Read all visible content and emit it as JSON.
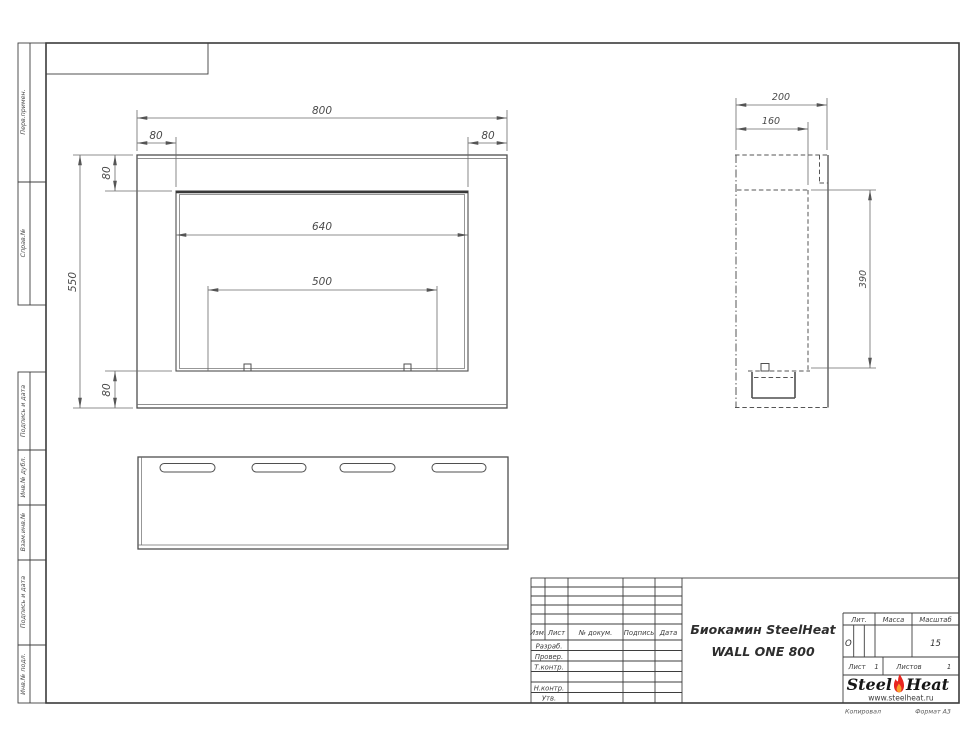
{
  "sheet": {
    "margins": [
      "Перв.примен.",
      "Справ.№",
      "Подпись и дата",
      "Инв.№ дубл.",
      "Взам.инв.№",
      "Подпись и дата",
      "Инв.№ подл."
    ],
    "footer": {
      "copied": "Копировал",
      "format": "Формат А3"
    }
  },
  "dimensions": {
    "front_width": "800",
    "front_margin_left": "80",
    "front_margin_right": "80",
    "front_margin_top": "80",
    "front_margin_bottom": "80",
    "front_height": "550",
    "opening_width": "640",
    "burner_width": "500",
    "side_depth": "200",
    "side_inner_depth": "160",
    "side_opening_height": "390"
  },
  "title_block": {
    "name_line1": "Биокамин SteelHeat",
    "name_line2": "WALL ONE 800",
    "col_izm": "Изм.",
    "col_list": "Лист",
    "col_doc": "№ докум.",
    "col_sign": "Подпись",
    "col_date": "Дата",
    "row_razrab": "Разраб.",
    "row_prover": "Провер.",
    "row_tkontr": "Т.контр.",
    "row_nkontr": "Н.контр.",
    "row_utv": "Утв.",
    "lit_label": "Лит.",
    "lit_value": "О",
    "mass_label": "Масса",
    "scale_label": "Масштаб",
    "scale_value": "15",
    "sheet_label": "Лист",
    "sheet_value": "1",
    "sheets_label": "Листов",
    "sheets_value": "1"
  },
  "logo": {
    "part1": "Steel",
    "part2": "Heat",
    "url": "www.steelheat.ru",
    "flame_icon": "flame",
    "flame_color": "#e8251f",
    "flame_inner_color": "#f8a02c"
  }
}
